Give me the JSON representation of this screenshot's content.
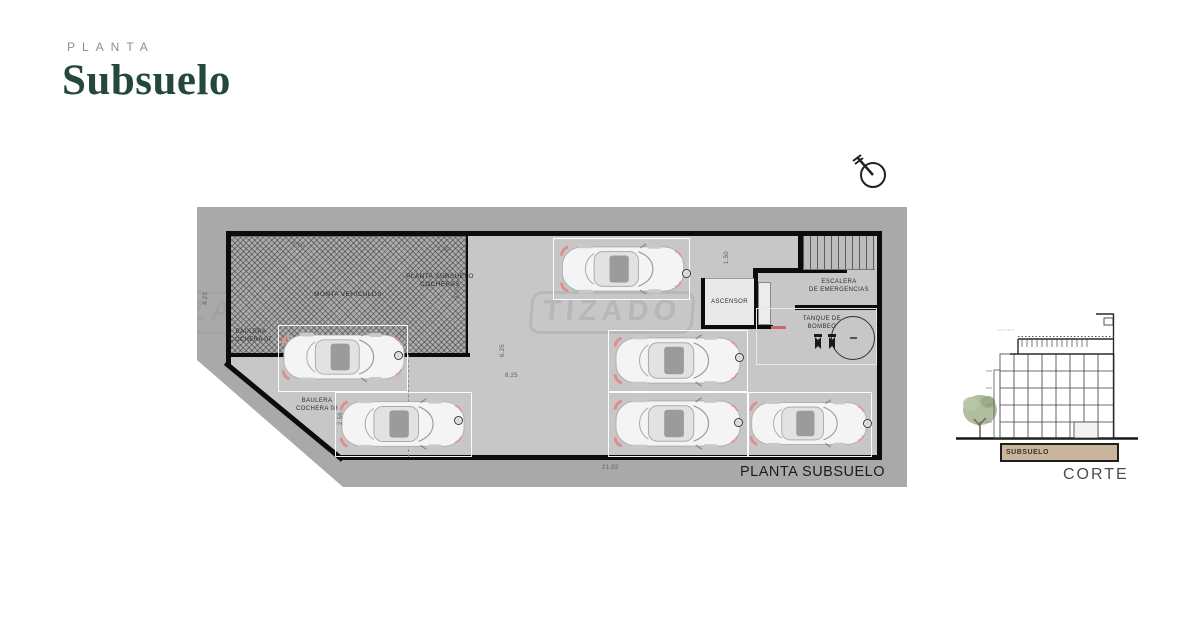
{
  "header": {
    "eyebrow": "PLANTA",
    "title": "Subsuelo"
  },
  "north": {
    "label": "N"
  },
  "plan": {
    "caption": "PLANTA SUBSUELO",
    "watermark": "TIZADO",
    "parking_spaces": 6,
    "rooms": {
      "monta": "MONTA VEHICULOS",
      "cocheras_l1": "PLANTA SUBSUELO",
      "cocheras_l2": "COCHERAS",
      "ascensor": "ASCENSOR",
      "escalera_l1": "ESCALERA",
      "escalera_l2": "DE EMERGENCIAS",
      "tanque_l1": "TANQUE DE",
      "tanque_l2": "BOMBEO",
      "baulera07_l1": "BAULERA",
      "baulera07_l2": "COCHERA 07",
      "baulera08_l1": "BAULERA",
      "baulera08_l2": "COCHERA 08"
    },
    "dimensions": {
      "monta_width": "7.00",
      "cocheras_width": "7.00",
      "left_height": "4.23",
      "corridor": "1.50",
      "mid_height": "6.25",
      "mid_width": "8.25",
      "baulera_height": "2.56",
      "monta_depth": "3.05",
      "total_width": "21.02"
    }
  },
  "section": {
    "caption": "CORTE",
    "basement_label": "SUBSUELO"
  },
  "colors": {
    "accent_green": "#24493a",
    "lot_gray": "#a9a9a9",
    "floor_gray": "#c7c7c7",
    "wall_black": "#0c0c0c",
    "basement_tan": "#c9b49c"
  }
}
